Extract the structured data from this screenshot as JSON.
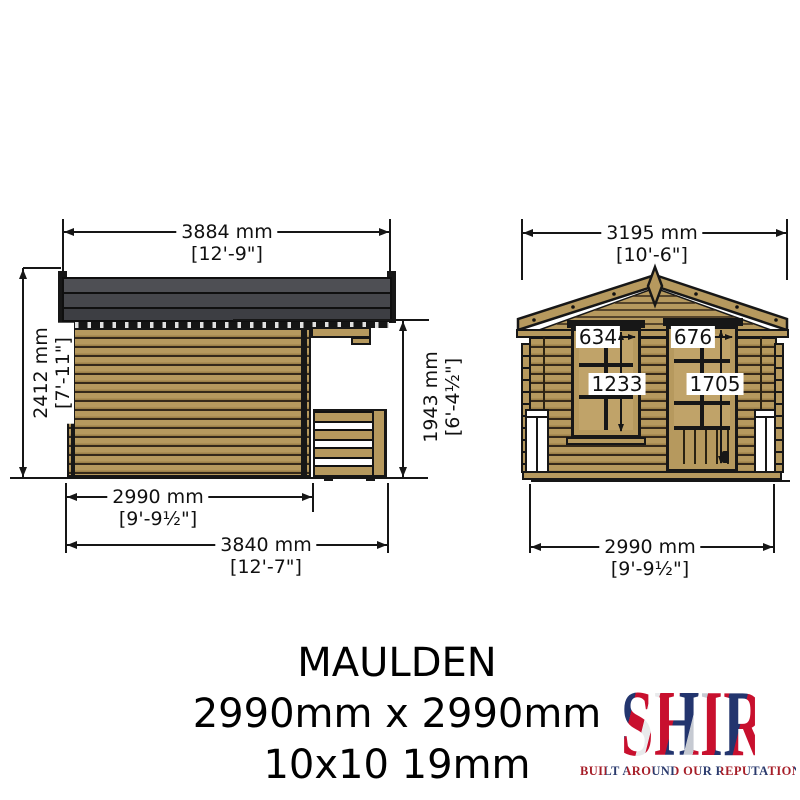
{
  "side_view": {
    "dim_width_roof": {
      "mm": "3884 mm",
      "ft": "[12'-9\"]"
    },
    "dim_height_total": {
      "mm": "2412 mm",
      "ft": "[7'-11\"]"
    },
    "dim_height_veranda": {
      "mm": "1943 mm",
      "ft": "[6'-4½\"]"
    },
    "dim_width_cabin": {
      "mm": "2990 mm",
      "ft": "[9'-9½\"]"
    },
    "dim_width_base": {
      "mm": "3840 mm",
      "ft": "[12'-7\"]"
    }
  },
  "front_view": {
    "dim_width_roof": {
      "mm": "3195 mm",
      "ft": "[10'-6\"]"
    },
    "dim_width_base": {
      "mm": "2990 mm",
      "ft": "[9'-9½\"]"
    },
    "window": {
      "width": "634",
      "height": "1233"
    },
    "door": {
      "width": "676",
      "height": "1705"
    }
  },
  "title_block": {
    "name": "MAULDEN",
    "size_mm": "2990mm x 2990mm",
    "size_spec": "10x10 19mm"
  },
  "logo": {
    "brand": "SHIRE",
    "tagline": "BUILT AROUND OUR REPUTATION"
  },
  "colors": {
    "wood": "#b6995e",
    "wood_line": "#35291a",
    "roof_grey": "#46474c",
    "drawing_line": "#161616",
    "brand_red": "#c8102e",
    "brand_blue": "#23356e"
  }
}
